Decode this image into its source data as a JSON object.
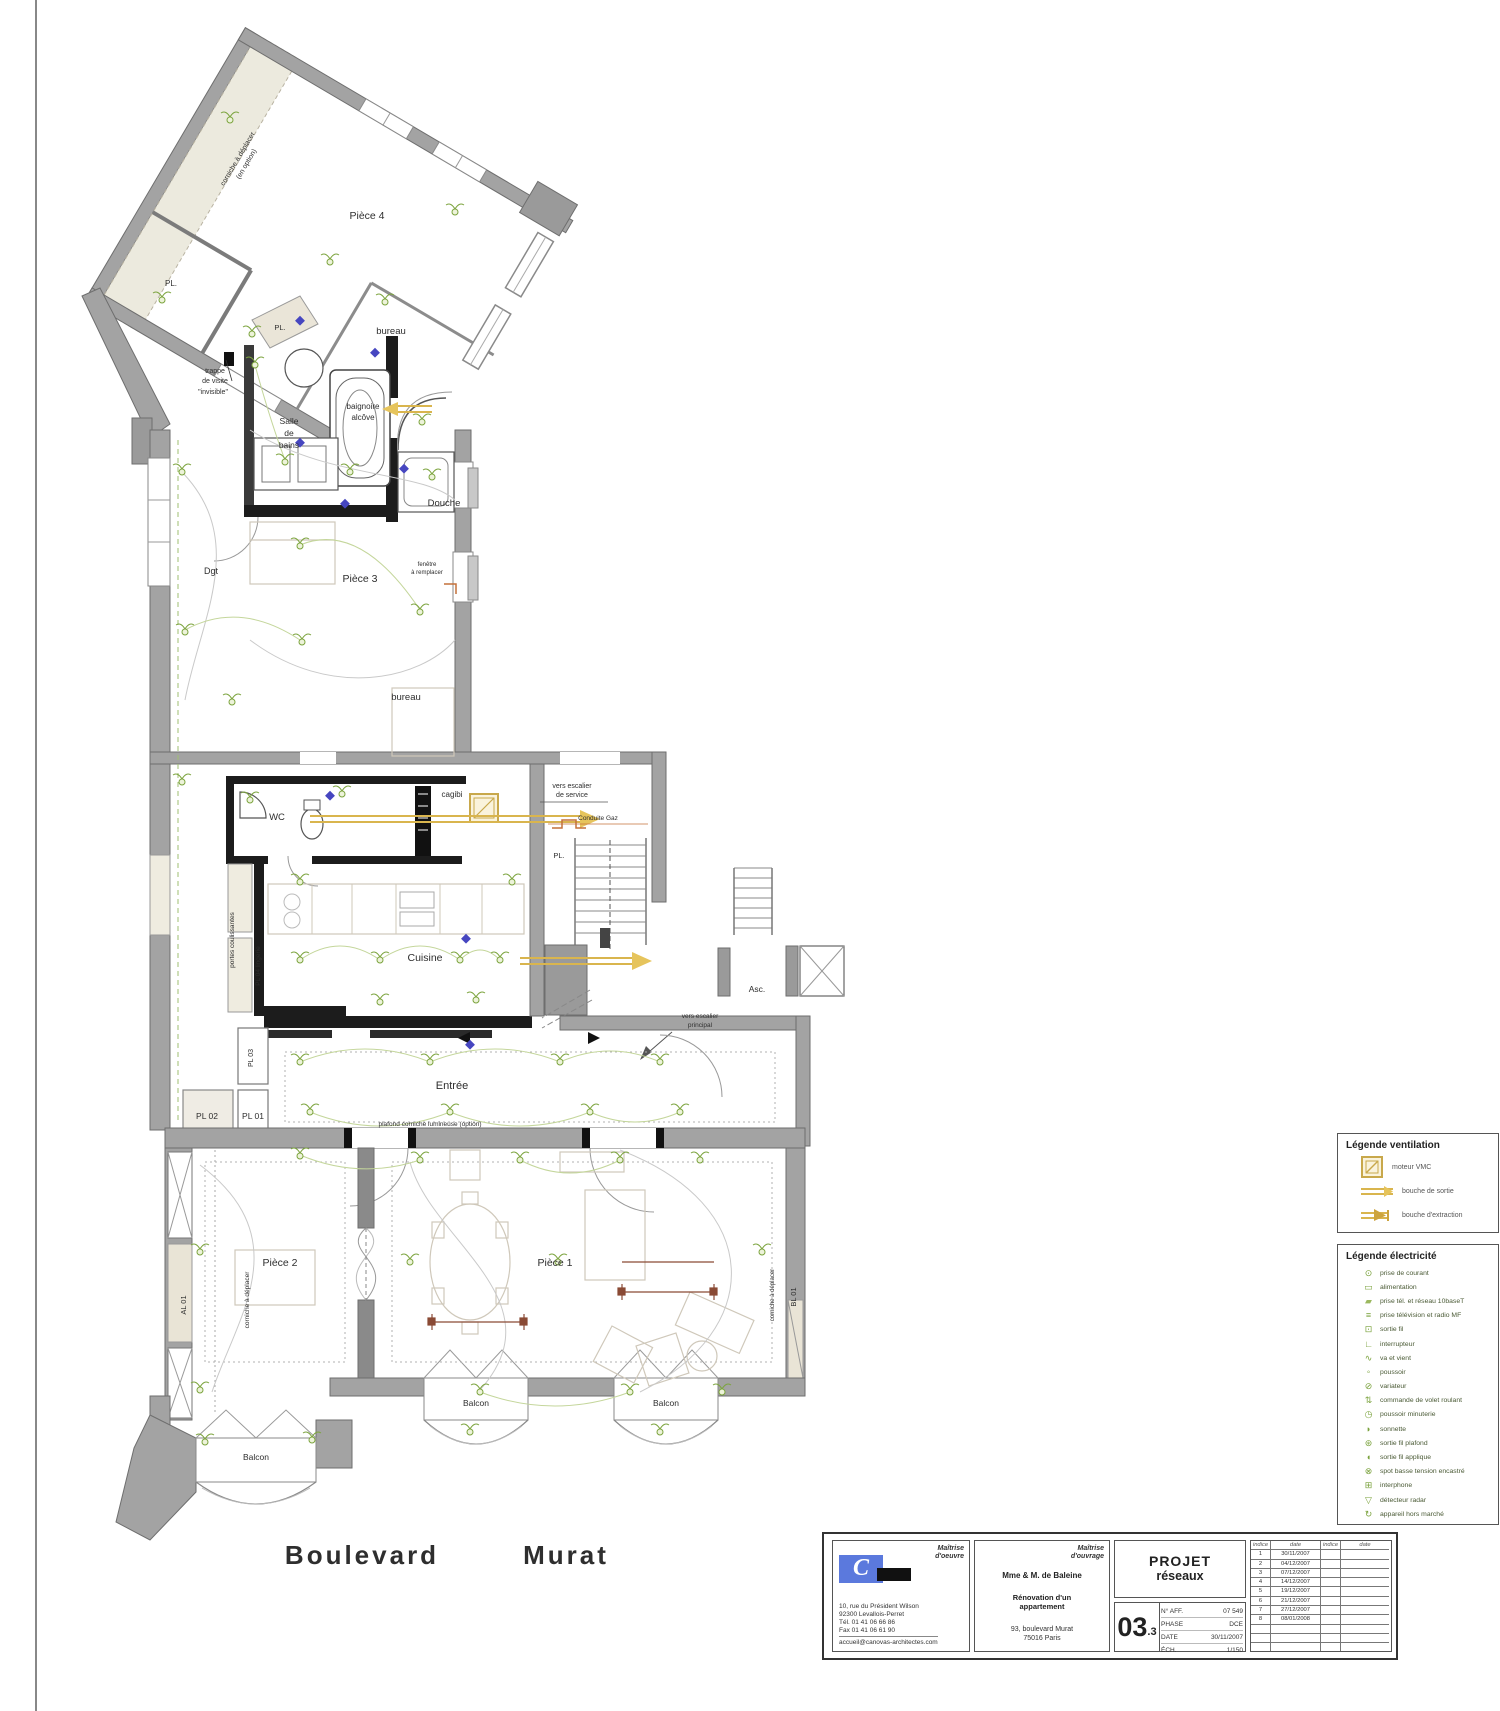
{
  "page": {
    "street_left": "Boulevard",
    "street_right": "Murat"
  },
  "plan": {
    "rooms": {
      "piece4": "Pièce 4",
      "bureau_top": "bureau",
      "pl_top": "PL.",
      "pl_bath": "PL.",
      "salle_1": "Salle",
      "salle_2": "de",
      "salle_3": "bains",
      "baignoire_1": "baignoire",
      "baignoire_2": "alcôve",
      "douche": "Douche",
      "dgt": "Dgt",
      "piece3": "Pièce 3",
      "bureau_mid": "bureau",
      "wc": "WC",
      "cagibi": "cagibi",
      "pl_stairs": "PL.",
      "cuisine": "Cuisine",
      "entree": "Entrée",
      "piece2": "Pièce 2",
      "piece1": "Pièce 1",
      "balcon_left": "Balcon",
      "balcon_mid": "Balcon",
      "balcon_right": "Balcon",
      "asc": "Asc."
    },
    "closets": {
      "pl01": "PL 01",
      "pl02": "PL 02",
      "pl03": "PL 03",
      "pl04": "PL 04 lingerie",
      "al01": "AL 01",
      "bl01": "BL 01"
    },
    "annotations": {
      "corniche_top_1": "corniche à déplacer",
      "corniche_top_2": "(en option)",
      "trappe_1": "trappe",
      "trappe_2": "de visite",
      "trappe_3": "\"invisible\"",
      "fenetre_1": "fenêtre",
      "fenetre_2": "à remplacer",
      "vers_service_1": "vers escalier",
      "vers_service_2": "de service",
      "conduite_gaz": "Conduite Gaz",
      "vers_principal_1": "vers escalier",
      "vers_principal_2": "principal",
      "portes_coulissantes": "portes coulissantes",
      "plafond": "plafond corniche lumineuse (option)",
      "corniche_left": "corniche à déplacer",
      "corniche_right": "corniche à déplacer"
    }
  },
  "legend_ventilation": {
    "title": "Légende ventilation",
    "items": [
      {
        "icon": "vmc-motor-icon",
        "label": "moteur VMC"
      },
      {
        "icon": "supply-duct-icon",
        "label": "bouche de sortie"
      },
      {
        "icon": "extract-duct-icon",
        "label": "bouche d'extraction"
      }
    ]
  },
  "legend_electricite": {
    "title": "Légende électricité",
    "items": [
      {
        "icon": "socket-icon",
        "label": "prise de courant"
      },
      {
        "icon": "supply-icon",
        "label": "alimentation"
      },
      {
        "icon": "network-icon",
        "label": "prise tél. et réseau 10baseT"
      },
      {
        "icon": "tv-icon",
        "label": "prise télévision et radio MF"
      },
      {
        "icon": "wire-outlet-icon",
        "label": "sortie fil"
      },
      {
        "icon": "switch-icon",
        "label": "interrupteur"
      },
      {
        "icon": "two-way-switch-icon",
        "label": "va et vient"
      },
      {
        "icon": "push-button-icon",
        "label": "poussoir"
      },
      {
        "icon": "dimmer-icon",
        "label": "variateur"
      },
      {
        "icon": "shutter-control-icon",
        "label": "commande de volet roulant"
      },
      {
        "icon": "timer-push-icon",
        "label": "poussoir minuterie"
      },
      {
        "icon": "bell-icon",
        "label": "sonnette"
      },
      {
        "icon": "ceiling-outlet-icon",
        "label": "sortie fil plafond"
      },
      {
        "icon": "sconce-outlet-icon",
        "label": "sortie fil applique"
      },
      {
        "icon": "recessed-spot-icon",
        "label": "spot basse tension encastré"
      },
      {
        "icon": "intercom-icon",
        "label": "interphone"
      },
      {
        "icon": "radar-detector-icon",
        "label": "détecteur radar"
      },
      {
        "icon": "off-market-device-icon",
        "label": "appareil hors marché"
      }
    ]
  },
  "title_block": {
    "architect": {
      "role": "Maîtrise\nd'oeuvre",
      "logo_letter": "C",
      "address_1": "10, rue du Président Wilson",
      "address_2": "92300 Levallois-Perret",
      "address_3": "Tél. 01 41 06 66 86",
      "address_4": "Fax 01 41 06 61 90",
      "website": "accueil@canovas-architectes.com"
    },
    "client": {
      "role": "Maîtrise\nd'ouvrage",
      "name": "Mme & M. de Baleine",
      "project_1": "Rénovation d'un",
      "project_2": "appartement",
      "address_1": "93, boulevard Murat",
      "address_2": "75016 Paris"
    },
    "project": {
      "line1": "PROJET",
      "line2": "réseaux"
    },
    "sheet": {
      "number": "03",
      "suffix": ".3",
      "aff_label": "N° AFF.",
      "aff_value": "07 549",
      "phase_label": "PHASE",
      "phase_value": "DCE",
      "date_label": "DATE",
      "date_value": "30/11/2007",
      "ech_label": "ÉCH.",
      "ech_value": "1/150"
    },
    "revisions": {
      "headers": [
        "indice",
        "date",
        "indice",
        "date"
      ],
      "rows": [
        [
          "1",
          "30/11/2007"
        ],
        [
          "2",
          "04/12/2007"
        ],
        [
          "3",
          "07/12/2007"
        ],
        [
          "4",
          "14/12/2007"
        ],
        [
          "5",
          "19/12/2007"
        ],
        [
          "6",
          "21/12/2007"
        ],
        [
          "7",
          "27/12/2007"
        ],
        [
          "8",
          "08/01/2008"
        ]
      ]
    }
  }
}
